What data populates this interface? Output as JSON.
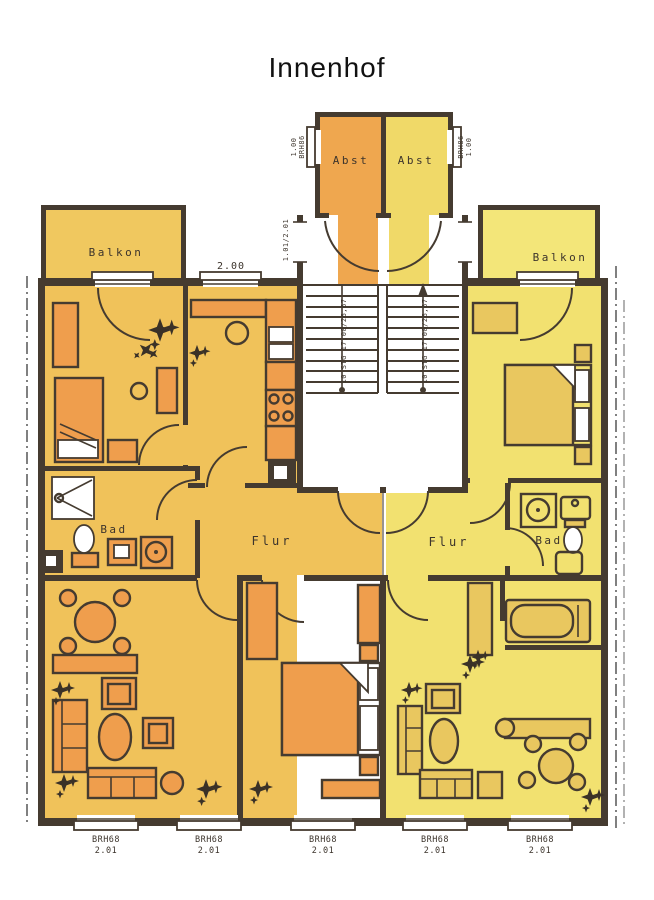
{
  "title": "Innenhof",
  "rooms": {
    "balkon_left": "Balkon",
    "balkon_right": "Balkon",
    "abst_left": "Abst",
    "abst_right": "Abst",
    "bad_left": "Bad",
    "bad_right": "Bad",
    "flur_left": "Flur",
    "flur_right": "Flur"
  },
  "annotations": {
    "kitchen_window_width": "2.00",
    "entry_door_size": "1.01/2.01",
    "stair_note": "10 STG 17,00/26,67",
    "abst_window_code": "BRH86",
    "abst_window_height": "1.00"
  },
  "windows": {
    "items": [
      {
        "code": "BRH68",
        "size": "2.01"
      },
      {
        "code": "BRH68",
        "size": "2.01"
      },
      {
        "code": "BRH68",
        "size": "2.01"
      },
      {
        "code": "BRH68",
        "size": "2.01"
      },
      {
        "code": "BRH68",
        "size": "2.01"
      }
    ]
  },
  "colors": {
    "wall": "#453b30",
    "left_apartment_floor": "#f0c25a",
    "right_apartment_floor": "#f2e170",
    "left_furniture": "#ef9e4d",
    "right_furniture": "#e9c75f",
    "abst_left": "#efa74f",
    "abst_right": "#f0d968",
    "balcony_left": "#f0c85f",
    "balcony_right": "#f3e679"
  }
}
